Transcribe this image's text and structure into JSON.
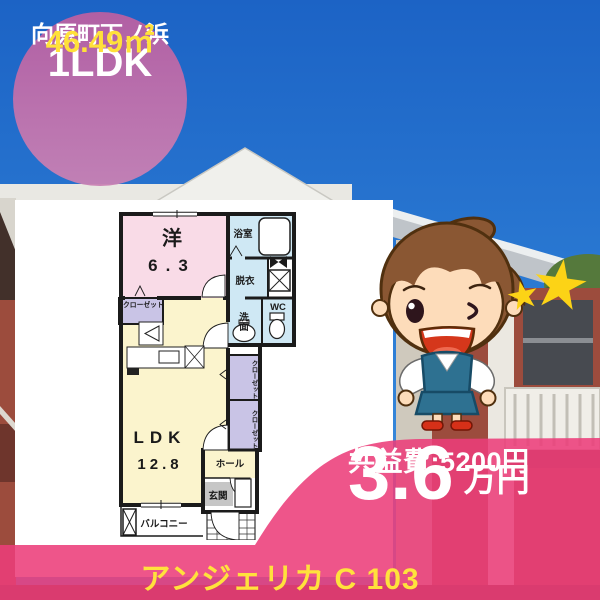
{
  "badge": {
    "layout_type": "1LDK",
    "location": "向原町下ノ浜",
    "area": "46.49㎡"
  },
  "floorplan": {
    "western_room_label": "洋",
    "western_room_size": "6.3",
    "ldk_label": "LDK",
    "ldk_size": "12.8",
    "bath": "浴室",
    "dressing": "脱衣",
    "washroom": "洗面",
    "toilet": "WC",
    "closet_left": "クローゼット",
    "closet_right_upper": "クローゼット",
    "closet_right_lower": "クローゼット",
    "hall": "ホール",
    "entrance": "玄関",
    "balcony": "バルコニー"
  },
  "price": {
    "rent": "3.6",
    "rent_unit": "万円",
    "common_fee": "共益費:5200円"
  },
  "property_title": "アンジェリカ C 103",
  "colors": {
    "accent_pink": "#ec3d7a",
    "badge_pink": "#bb61a4",
    "highlight_yellow": "#ffe13a",
    "sky_blue": "#2a79d2"
  }
}
